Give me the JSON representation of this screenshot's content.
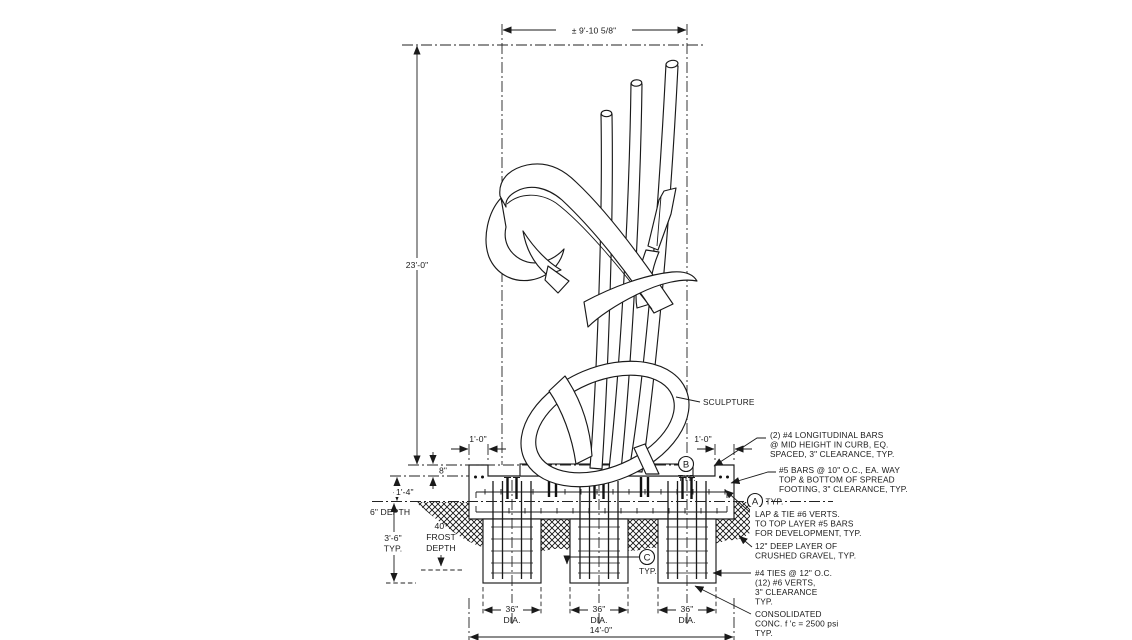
{
  "drawing": {
    "sculpture_label": "SCULPTURE",
    "dims": {
      "envelope_width": "± 9'-10 5/8\"",
      "overall_height": "23'-0\"",
      "curb_left_width": "1'-0\"",
      "curb_right_width": "1'-0\"",
      "curb_reveal": "8\"",
      "footing_to_grade": "1'-4\"",
      "topsoil_depth": "6\" DEPTH",
      "pier_embed_value": "3'-6\"",
      "pier_embed_typ": "TYP.",
      "frost_value": "40\"",
      "frost_word1": "FROST",
      "frost_word2": "DEPTH",
      "pier_dia_value": "36\"",
      "pier_dia_unit": "DIA.",
      "footing_width": "14'-0\""
    },
    "callouts": {
      "a": "A",
      "b": "B",
      "c": "C",
      "typ": "TYP."
    },
    "notes": {
      "n1": [
        "(2) #4 LONGITUDINAL BARS",
        "@ MID HEIGHT IN CURB, EQ.",
        "SPACED, 3\" CLEARANCE, TYP."
      ],
      "n2": [
        "#5 BARS @ 10\" O.C., EA. WAY",
        "TOP & BOTTOM OF SPREAD",
        "FOOTING, 3\" CLEARANCE, TYP."
      ],
      "n3": [
        "LAP & TIE #6 VERTS.",
        "TO TOP LAYER #5 BARS",
        "FOR DEVELOPMENT, TYP."
      ],
      "n4": [
        "12\" DEEP LAYER OF",
        "CRUSHED GRAVEL, TYP."
      ],
      "n5": [
        "#4 TIES @ 12\" O.C.",
        "(12) #6 VERTS,",
        "3\" CLEARANCE",
        "TYP."
      ],
      "n6": [
        "CONSOLIDATED",
        "CONC. f 'c = 2500 psi",
        "TYP."
      ]
    },
    "colors": {
      "line": "#1a1a1a",
      "background": "#ffffff"
    }
  }
}
